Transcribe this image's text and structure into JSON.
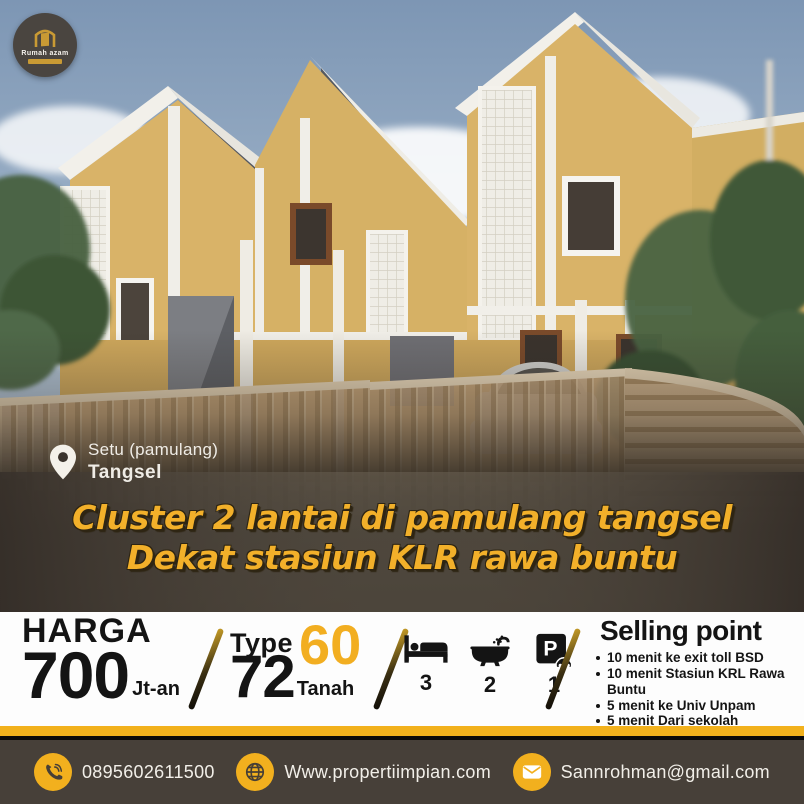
{
  "brand": {
    "logo_text": "Rumah azam"
  },
  "location": {
    "line1": "Setu (pamulang)",
    "line2": "Tangsel"
  },
  "title": {
    "line1": "Cluster 2 lantai di pamulang tangsel",
    "line2": "Dekat stasiun KLR rawa buntu"
  },
  "price": {
    "label": "HARGA",
    "value": "700",
    "unit": "Jt-an"
  },
  "type": {
    "label": "Type",
    "building": "60",
    "land": "72",
    "land_label": "Tanah"
  },
  "features": [
    {
      "icon": "bed-icon",
      "count": "3"
    },
    {
      "icon": "bath-icon",
      "count": "2"
    },
    {
      "icon": "parking-icon",
      "count": "1"
    }
  ],
  "selling": {
    "heading": "Selling point",
    "items": [
      "10 menit ke exit toll BSD",
      "10 menit Stasiun KRL Rawa Buntu",
      "5 menit ke Univ Unpam",
      "5 menit Dari sekolah"
    ]
  },
  "contact": {
    "phone": "0895602611500",
    "website": "Www.propertiimpian.com",
    "email": "Sannrohman@gmail.com"
  },
  "colors": {
    "accent_gold": "#F2B01E",
    "title_yellow": "#F2B02A",
    "footer_bg": "#474039",
    "wall_tan": "#D9B368"
  }
}
